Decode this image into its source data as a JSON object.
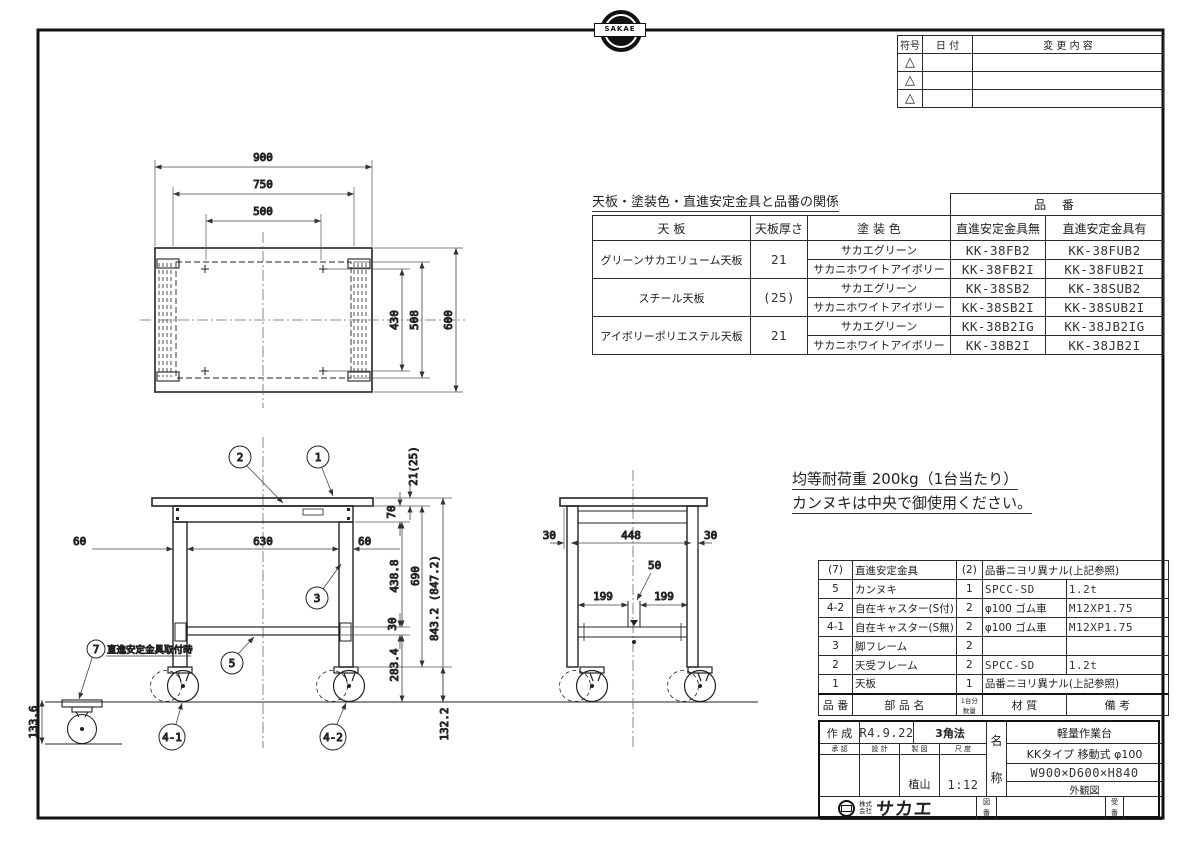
{
  "logo": {
    "brand": "SAKAE",
    "company_prefix_1": "株式",
    "company_prefix_2": "会社",
    "company_name": "サカエ"
  },
  "revision_table": {
    "col_symbol": "符号",
    "col_date": "日  付",
    "col_change": "変 更 内 容",
    "marker": "△"
  },
  "spec_table": {
    "title": "天板・塗装色・直進安定金具と品番の関係",
    "part_no": "品 番",
    "h_top": "天  板",
    "h_thickness": "天板厚さ",
    "h_color": "塗  装  色",
    "h_without": "直進安定金具無",
    "h_with": "直進安定金具有",
    "groups": [
      {
        "top": "グリーンサカエリューム天板",
        "thickness": "21",
        "rows": [
          {
            "color": "サカエグリーン",
            "without": "KK-38FB2",
            "with": "KK-38FUB2"
          },
          {
            "color": "サカニホワイトアイボリー",
            "without": "KK-38FB2I",
            "with": "KK-38FUB2I"
          }
        ]
      },
      {
        "top": "スチール天板",
        "thickness": "(25)",
        "rows": [
          {
            "color": "サカエグリーン",
            "without": "KK-38SB2",
            "with": "KK-38SUB2"
          },
          {
            "color": "サカニホワイトアイボリー",
            "without": "KK-38SB2I",
            "with": "KK-38SUB2I"
          }
        ]
      },
      {
        "top": "アイボリーポリエステル天板",
        "thickness": "21",
        "rows": [
          {
            "color": "サカエグリーン",
            "without": "KK-38B2IG",
            "with": "KK-38JB2IG"
          },
          {
            "color": "サカニホワイトアイボリー",
            "without": "KK-38B2I",
            "with": "KK-38JB2I"
          }
        ]
      }
    ]
  },
  "notes": {
    "line1": "均等耐荷重  200kg（1台当たり）",
    "line2": "カンヌキは中央で御使用ください。"
  },
  "parts_table": {
    "h_no": "品 番",
    "h_name": "部 品 名",
    "h_qty1": "1台分",
    "h_qty2": "数量",
    "h_material": "材    質",
    "h_remarks": "備    考",
    "rows": [
      {
        "no": "(7)",
        "name": "直進安定金具",
        "qty": "(2)",
        "material": "品番ニヨリ異ナル(上記参照)",
        "remarks": ""
      },
      {
        "no": "5",
        "name": "カンヌキ",
        "qty": "1",
        "material": "SPCC-SD",
        "remarks": "1.2t"
      },
      {
        "no": "4-2",
        "name": "自在キャスター(S付)",
        "qty": "2",
        "material": "φ100 ゴム車",
        "remarks": "M12XP1.75"
      },
      {
        "no": "4-1",
        "name": "自在キャスター(S無)",
        "qty": "2",
        "material": "φ100 ゴム車",
        "remarks": "M12XP1.75"
      },
      {
        "no": "3",
        "name": "脚フレーム",
        "qty": "2",
        "material": "",
        "remarks": ""
      },
      {
        "no": "2",
        "name": "天受フレーム",
        "qty": "2",
        "material": "SPCC-SD",
        "remarks": "1.2t"
      },
      {
        "no": "1",
        "name": "天板",
        "qty": "1",
        "material": "品番ニヨリ異ナル(上記参照)",
        "remarks": ""
      }
    ]
  },
  "title_block": {
    "created_label": "作 成",
    "created": "R4.9.22",
    "projection": "3角法",
    "h_approve": "承 認",
    "h_design": "設 計",
    "h_draft": "製 図",
    "h_scale": "尺 度",
    "drafter": "植山",
    "scale": "1:12",
    "name_char1": "名",
    "name_char2": "称",
    "product_line1": "軽量作業台",
    "product_line2": "KKタイプ 移動式 φ100",
    "product_line3": "W900×D600×H840",
    "product_line4": "外観図",
    "dwg_no_1": "図",
    "dwg_no_2": "番",
    "ref_no_1": "受",
    "ref_no_2": "番"
  },
  "dims": {
    "top": {
      "w": "900",
      "wf": "750",
      "wi": "500",
      "di": "430",
      "df": "508",
      "d": "600"
    },
    "front": {
      "oh_l": "60",
      "span": "630",
      "oh_r": "60",
      "thk": "21(25)",
      "frame_h": "70",
      "leg_upper": "438.8",
      "leg": "690",
      "bar": "30",
      "leg_lower": "283.4",
      "total": "843.2 (847.2)",
      "caster": "132.2",
      "caster_hw": "133.6"
    },
    "side": {
      "oh_l": "30",
      "span": "448",
      "oh_r": "30",
      "bar_off": "50",
      "half_l": "199",
      "half_r": "199"
    }
  },
  "balloons": {
    "b1": "1",
    "b2": "2",
    "b3": "3",
    "b5": "5",
    "b7": "7",
    "b41": "4-1",
    "b42": "4-2",
    "b7_note": "直進安定金具取付時"
  }
}
